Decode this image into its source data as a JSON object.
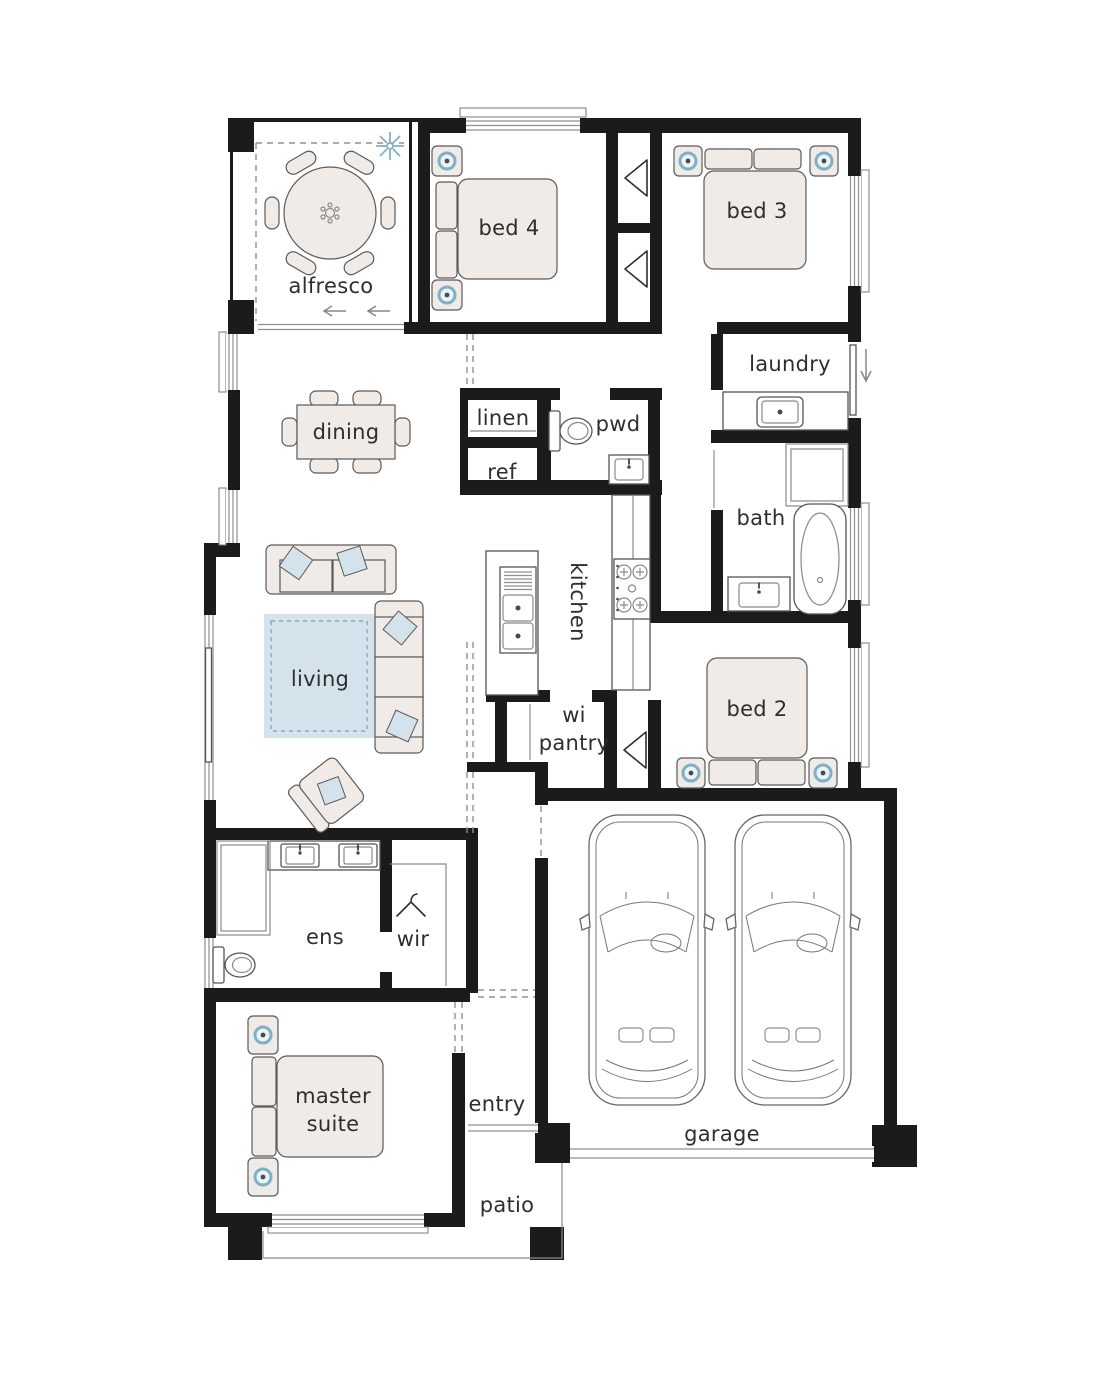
{
  "plan": {
    "rooms": {
      "alfresco": "alfresco",
      "bed4": "bed 4",
      "bed3": "bed 3",
      "laundry": "laundry",
      "linen": "linen",
      "pwd": "pwd",
      "ref": "ref",
      "dining": "dining",
      "bath": "bath",
      "kitchen": "kitchen",
      "wi_pantry_line1": "wi",
      "wi_pantry_line2": "pantry",
      "bed2": "bed 2",
      "living": "living",
      "ens": "ens",
      "wir": "wir",
      "master_line1": "master",
      "master_line2": "suite",
      "entry": "entry",
      "garage": "garage",
      "patio": "patio"
    },
    "colors": {
      "wall": "#1b1b1b",
      "furniture": "#f0ebe6",
      "accent": "#d4e2ec",
      "accentRing": "#7fb0c6",
      "text": "#2e2e2e",
      "bg": "#ffffff"
    },
    "icons": {
      "ceiling_fan": "starburst",
      "coat_hanger": "hanger",
      "door_swing": "flag-triangle",
      "exit_arrow": "down-arrow",
      "slide_direction": "left-arrow",
      "bedside_lamp": "ring-dot"
    }
  }
}
